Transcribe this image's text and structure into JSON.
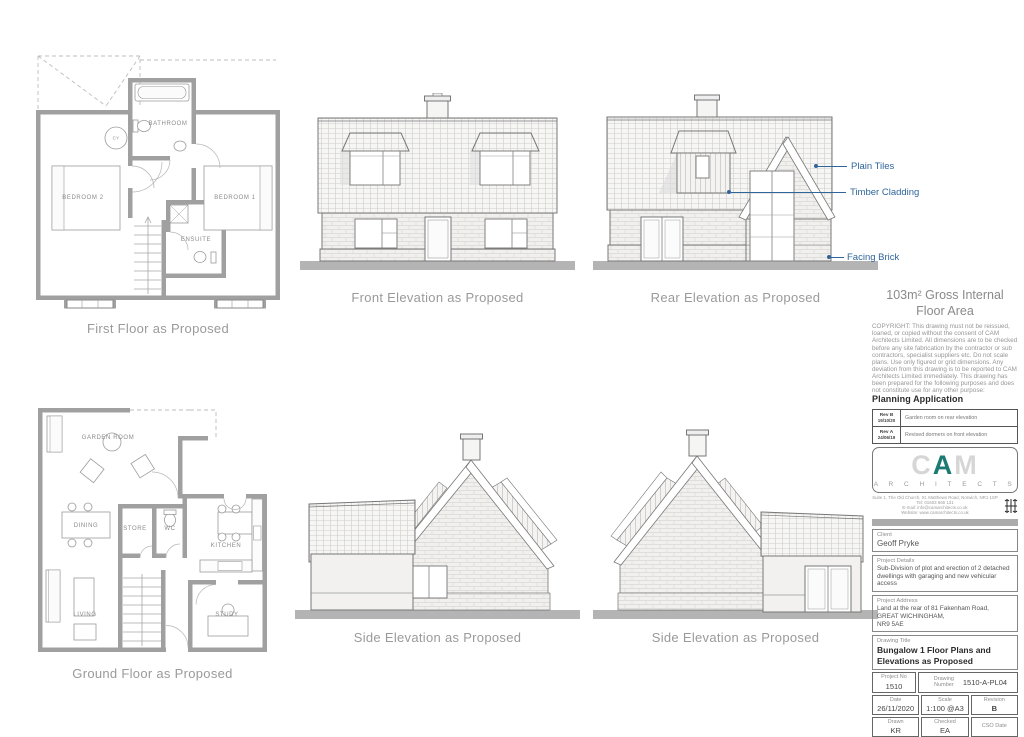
{
  "colors": {
    "annotation_blue": "#2f659b",
    "logo_teal": "#1b7a72",
    "caption_gray": "#9a9a9a"
  },
  "drawings": {
    "first_floor": {
      "caption": "First Floor as Proposed",
      "labels": {
        "bedroom2": "BEDROOM 2",
        "bathroom": "BATHROOM",
        "cy": "CY",
        "bedroom1": "BEDROOM 1",
        "ensuite": "ENSUITE"
      }
    },
    "ground_floor": {
      "caption": "Ground Floor as Proposed",
      "labels": {
        "garden_room": "GARDEN ROOM",
        "dining": "DINING",
        "store": "STORE",
        "wc": "WC",
        "kitchen": "KITCHEN",
        "living": "LIVING",
        "study": "STUDY"
      }
    },
    "front_elevation": {
      "caption": "Front Elevation as Proposed"
    },
    "rear_elevation": {
      "caption": "Rear Elevation as Proposed"
    },
    "side_elevation_left": {
      "caption": "Side Elevation as Proposed"
    },
    "side_elevation_right": {
      "caption": "Side Elevation as Proposed"
    },
    "material_annotations": {
      "plain_tiles": "Plain Tiles",
      "timber_cladding": "Timber Cladding",
      "facing_brick": "Facing Brick"
    }
  },
  "title_block": {
    "area_heading": "103m² Gross Internal Floor Area",
    "copyright": "COPYRIGHT: This drawing must not be reissued, loaned, or copied without the consent of CAM Architects Limited. All dimensions are to be checked before any site fabrication by the contractor or sub contractors, specialist suppliers etc. Do not scale plans. Use only figured or grid dimensions. Any deviation from this drawing is to be reported to CAM Architects Limited immediately. This drawing has been prepared for the following purposes and does not constitute use for any other purpose:",
    "purpose": "Planning Application",
    "revisions": [
      {
        "rev": "Rev B",
        "date": "19/10/20",
        "desc": "Garden room on rear elevation"
      },
      {
        "rev": "Rev A",
        "date": "24/06/19",
        "desc": "Revised dormers on front elevation"
      }
    ],
    "logo": {
      "c": "C",
      "a": "A",
      "m": "M",
      "word": "A R C H I T E C T S"
    },
    "address_line1": "Suite 1, The Old Church, St. Matthews Road, Norwich, NR1 1SP",
    "address_line2": "Tel: 01603 666 131",
    "address_line3": "E-mail: info@camarchitects.co.uk",
    "address_line4": "Website: www.camarchitects.co.uk",
    "fields": {
      "client_label": "Client",
      "client": "Geoff Pryke",
      "project_details_label": "Project Details",
      "project_details": "Sub-Division of plot and erection of 2 detached dwellings with garaging and new vehicular access",
      "project_address_label": "Project Address",
      "project_address_l1": "Land at the rear of 81 Fakenham Road,",
      "project_address_l2": "GREAT WICHINGHAM,",
      "project_address_l3": "NR9 5AE",
      "drawing_title_label": "Drawing Title",
      "drawing_title": "Bungalow 1 Floor Plans and Elevations as Proposed",
      "project_no_label": "Project No",
      "project_no": "1510",
      "drawing_number_label": "Drawing Number",
      "drawing_number": "1510-A-PL04",
      "date_label": "Date",
      "date": "26/11/2020",
      "scale_label": "Scale",
      "scale": "1:100 @A3",
      "revision_label": "Revision",
      "revision": "B",
      "drawn_label": "Drawn",
      "drawn": "KR",
      "checked_label": "Checked",
      "checked": "EA",
      "cso_label": "CSO Date",
      "cso": ""
    }
  }
}
